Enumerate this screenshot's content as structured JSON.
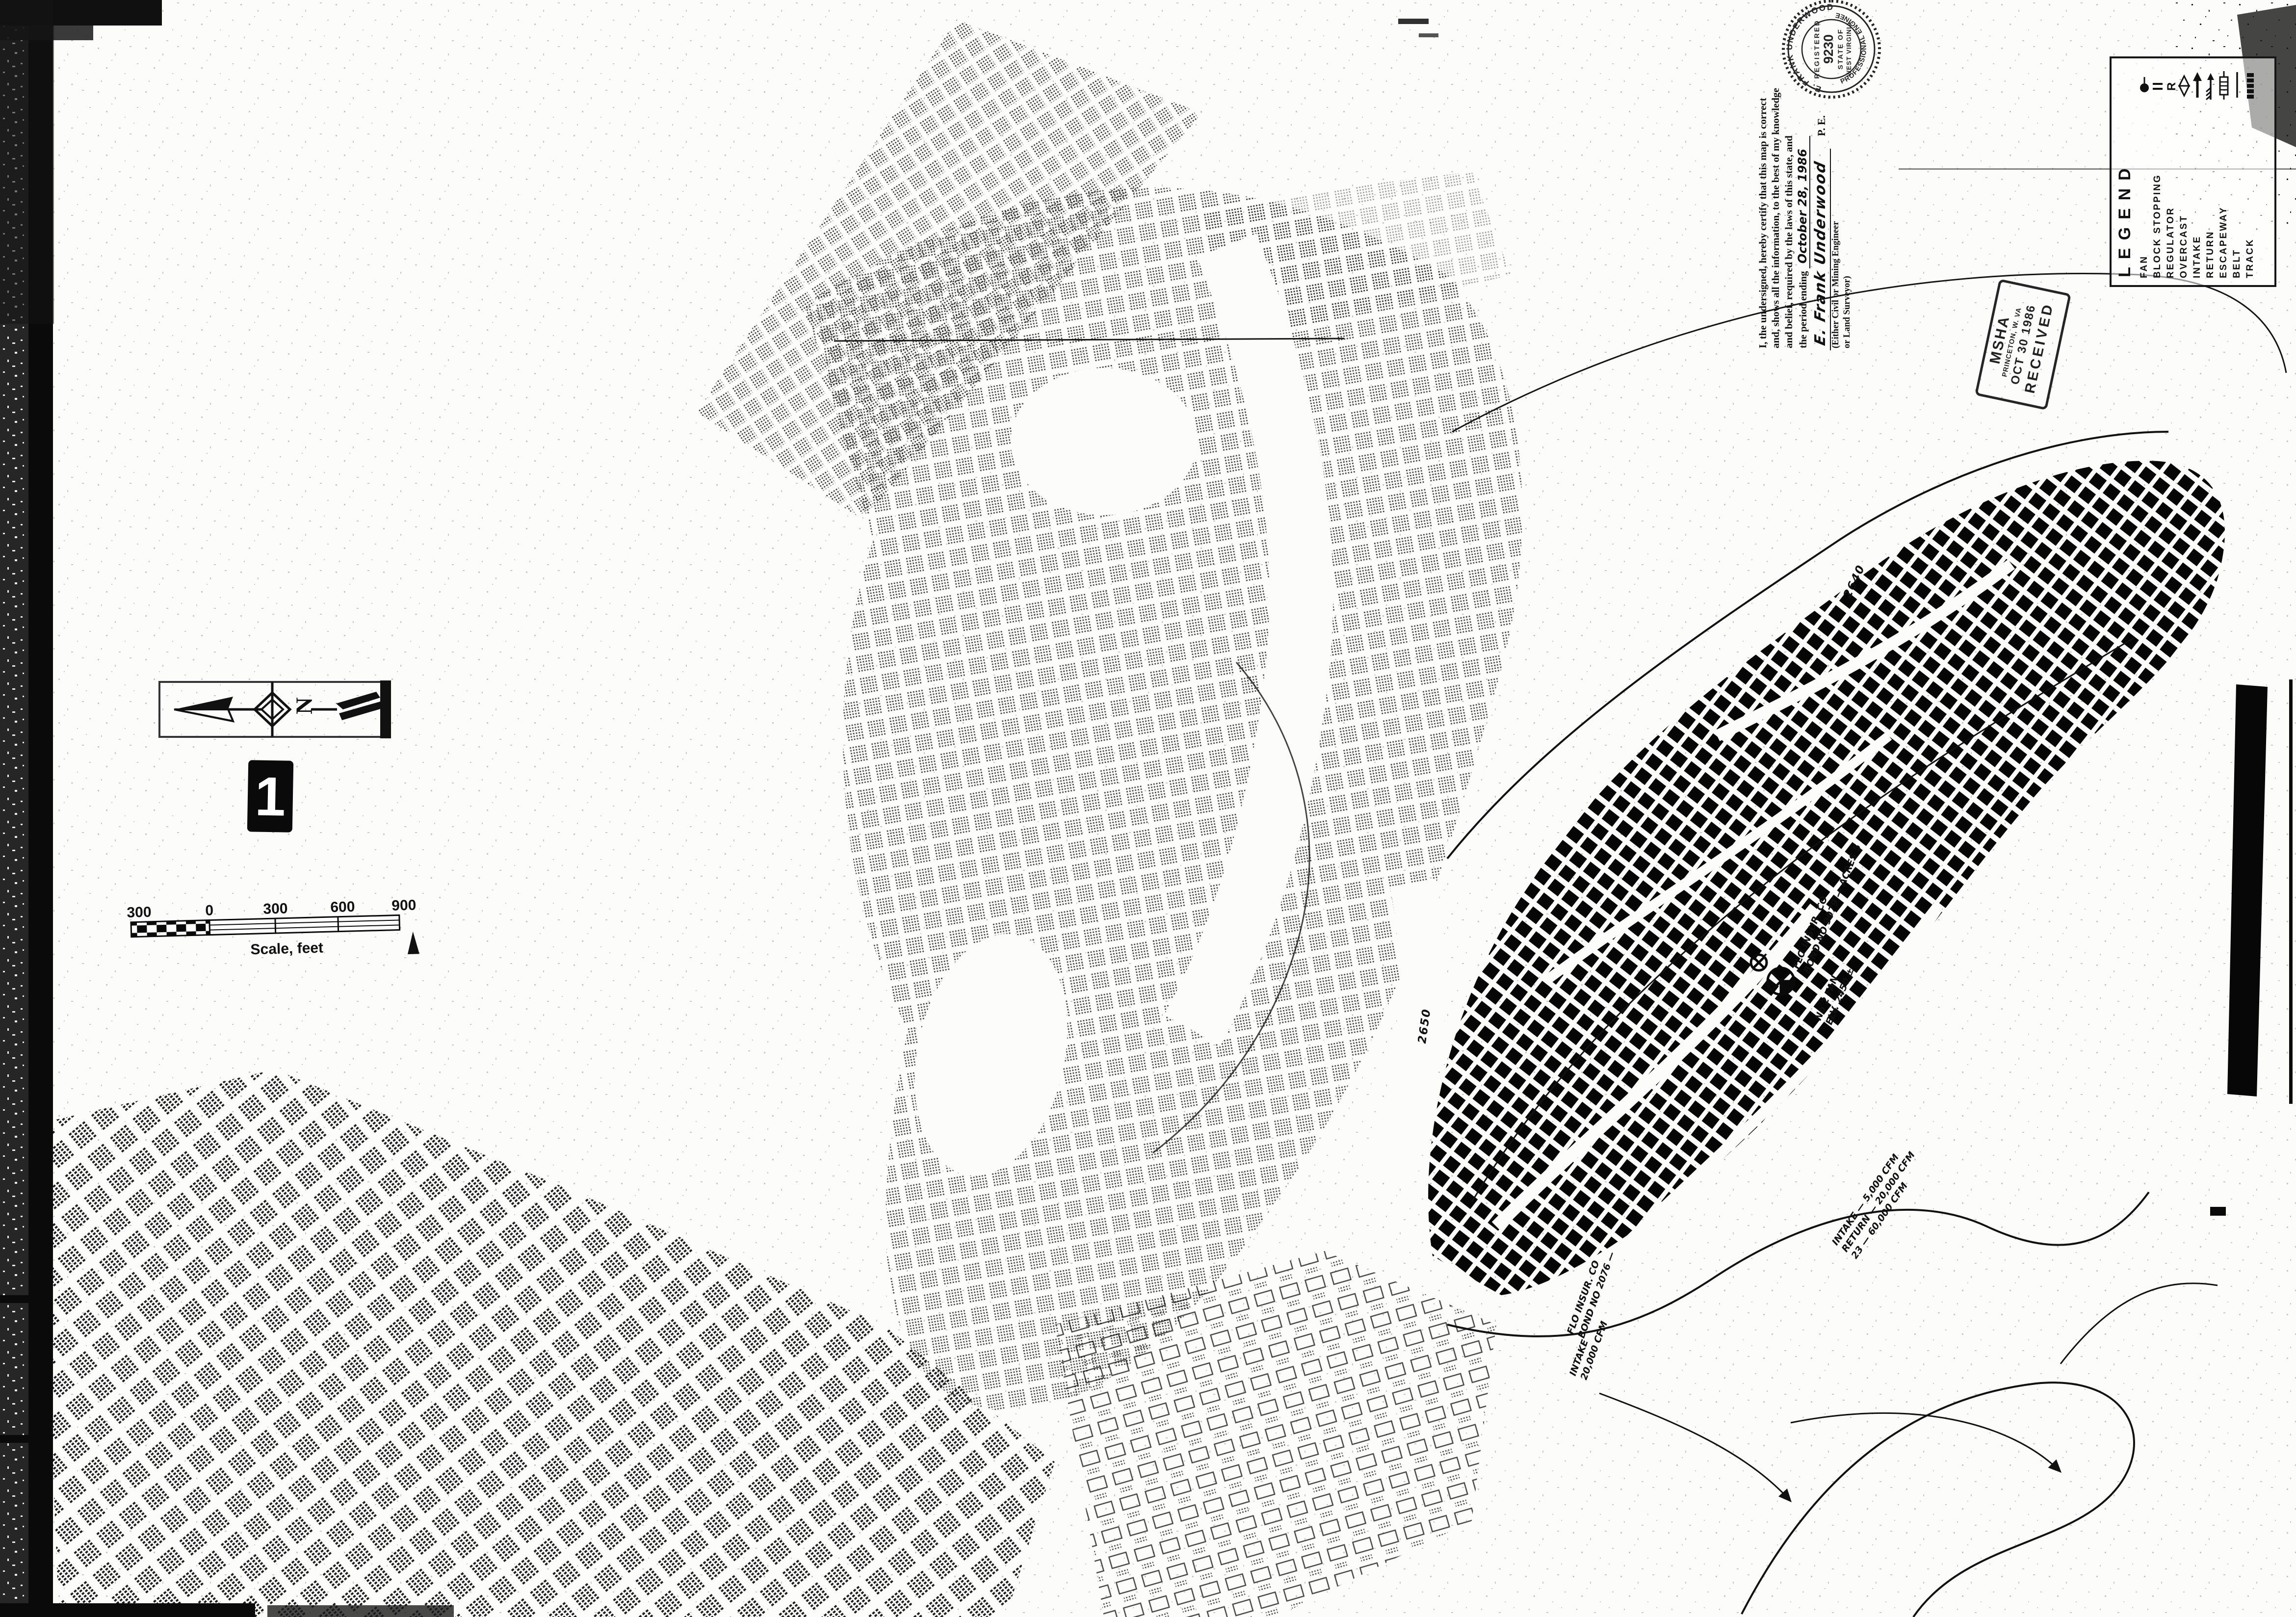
{
  "page": {
    "sheet_number": "1"
  },
  "legend": {
    "title": "LEGEND",
    "items": [
      {
        "label": "FAN",
        "symbol": "fan-symbol"
      },
      {
        "label": "BLOCK STOPPING",
        "symbol": "double-line-symbol"
      },
      {
        "label": "REGULATOR",
        "symbol": "letter-symbol",
        "symbol_text": "R"
      },
      {
        "label": "OVERCAST",
        "symbol": "bowtie-symbol"
      },
      {
        "label": "INTAKE",
        "symbol": "solid-arrow-symbol"
      },
      {
        "label": "RETURN",
        "symbol": "feathered-arrow-symbol"
      },
      {
        "label": "ESCAPEWAY",
        "symbol": "barred-rectangle-symbol"
      },
      {
        "label": "BELT",
        "symbol": "single-line-symbol"
      },
      {
        "label": "TRACK",
        "symbol": "hatched-line-symbol"
      }
    ]
  },
  "certification": {
    "lines": [
      "I, the undersigned, hereby certify that this map is correct",
      "and, shows all the information, to the best of my knowledge",
      "and belief, required by the laws of this state, and",
      "the period ending"
    ],
    "date_handwritten": "October 28, 1986",
    "signature": "E. Frank Underwood",
    "signature_suffix": "P. E.",
    "note_lines": [
      "(Either Civil or Mining Engineer",
      "or Land Surveyor)"
    ]
  },
  "seal": {
    "name_top": "E. FRANK UNDERWOOD",
    "bottom": "PROFESSIONAL ENGINEER",
    "registered": "REGISTERED",
    "number": "9230",
    "state_line1": "STATE OF",
    "state_line2": "WEST VIRGINIA"
  },
  "received_stamp": {
    "agency": "MSHA",
    "office": "PRINCETON, W. VA",
    "date": "OCT 30 1986",
    "status": "RECEIVED"
  },
  "scale_bar": {
    "labels": [
      "300",
      "0",
      "300",
      "600",
      "900"
    ],
    "caption": "Scale, feet"
  },
  "compass": {
    "label": "N"
  },
  "annotations": [
    {
      "lines": [
        "FLO INSUR. CO",
        "BOND NO 9079 — ACRES 5"
      ]
    },
    {
      "lines": [
        "No 2 FAN",
        "ELV. 2450 ±"
      ]
    },
    {
      "lines": [
        "INTAKE — 5,000 CFM",
        "RETURN — 20,000 CFM",
        "23 — 60,000 CFM"
      ]
    },
    {
      "lines": [
        "FLO INSUR. CO",
        "BOND NO 2076 —"
      ]
    },
    {
      "lines": [
        "INTAKE",
        "20,000 CFM"
      ]
    }
  ],
  "contour_labels": [
    {
      "text": "2650"
    },
    {
      "text": "2640"
    }
  ]
}
